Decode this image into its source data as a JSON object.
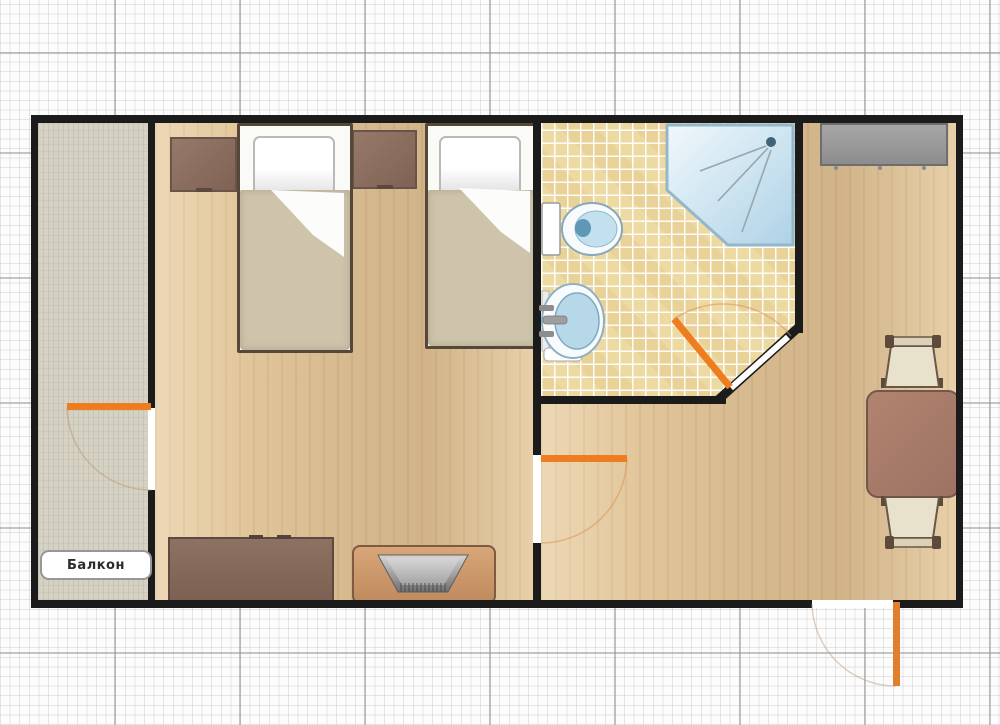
{
  "plan": {
    "balcony_label": "Балкон",
    "rooms": [
      "balcony",
      "bedroom",
      "bathroom",
      "living-room"
    ],
    "furniture": [
      "single-bed",
      "single-bed",
      "nightstand",
      "nightstand",
      "dresser",
      "tv-on-stand",
      "wardrobe",
      "dining-table",
      "chair",
      "chair",
      "toilet",
      "sink",
      "corner-shower"
    ],
    "doors": [
      "balcony-door",
      "room-divider-door",
      "bathroom-door",
      "entrance-door"
    ],
    "colors": {
      "wall": "#1b1b1b",
      "door_accent": "#ee7d1f",
      "wood_floor": "#e2c69b",
      "tile_floor": "#eddaa3",
      "balcony_floor": "#d5d1c3",
      "furniture_brown": "#8a6e5f",
      "fixture_blue": "#b7d8e9",
      "wardrobe_gray": "#9c9c9c"
    }
  }
}
